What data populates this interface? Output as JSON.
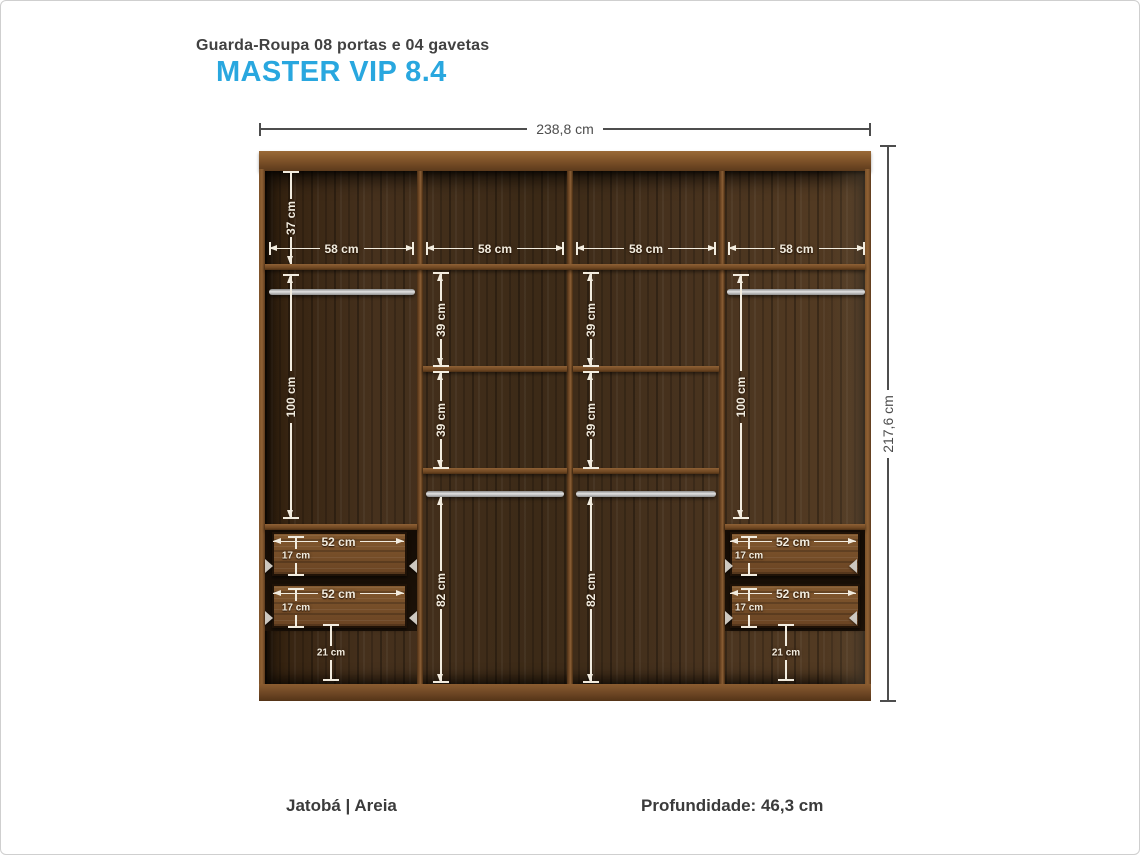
{
  "header": {
    "product_type": "Guarda-Roupa 08 portas e 04 gavetas",
    "model_name": "MASTER VIP 8.4"
  },
  "diagram": {
    "dims": {
      "width_total": "238,8 cm",
      "height_total": "217,6 cm",
      "top_shelf_height": "37 cm",
      "column_widths": [
        "58 cm",
        "58 cm",
        "58 cm",
        "58 cm"
      ],
      "hanging_heights": [
        "100 cm",
        "100 cm"
      ],
      "shelf_gaps": [
        "39 cm",
        "39 cm",
        "39 cm",
        "39 cm"
      ],
      "below_rod_heights": [
        "82 cm",
        "82 cm"
      ],
      "drawer_widths": [
        "52 cm",
        "52 cm",
        "52 cm",
        "52 cm"
      ],
      "drawer_heights": [
        "17 cm",
        "17 cm",
        "17 cm",
        "17 cm"
      ],
      "below_drawer_heights": [
        "21 cm",
        "21 cm"
      ]
    }
  },
  "footer": {
    "finish": "Jatobá | Areia",
    "depth": "Profundidade: 46,3 cm"
  },
  "colors": {
    "accent_blue": "#29a7df",
    "wood_dark": "#402c19",
    "wood_light": "#7c5229",
    "dimension_light": "#f2ecdf",
    "dimension_dark": "#4d4d4d"
  }
}
